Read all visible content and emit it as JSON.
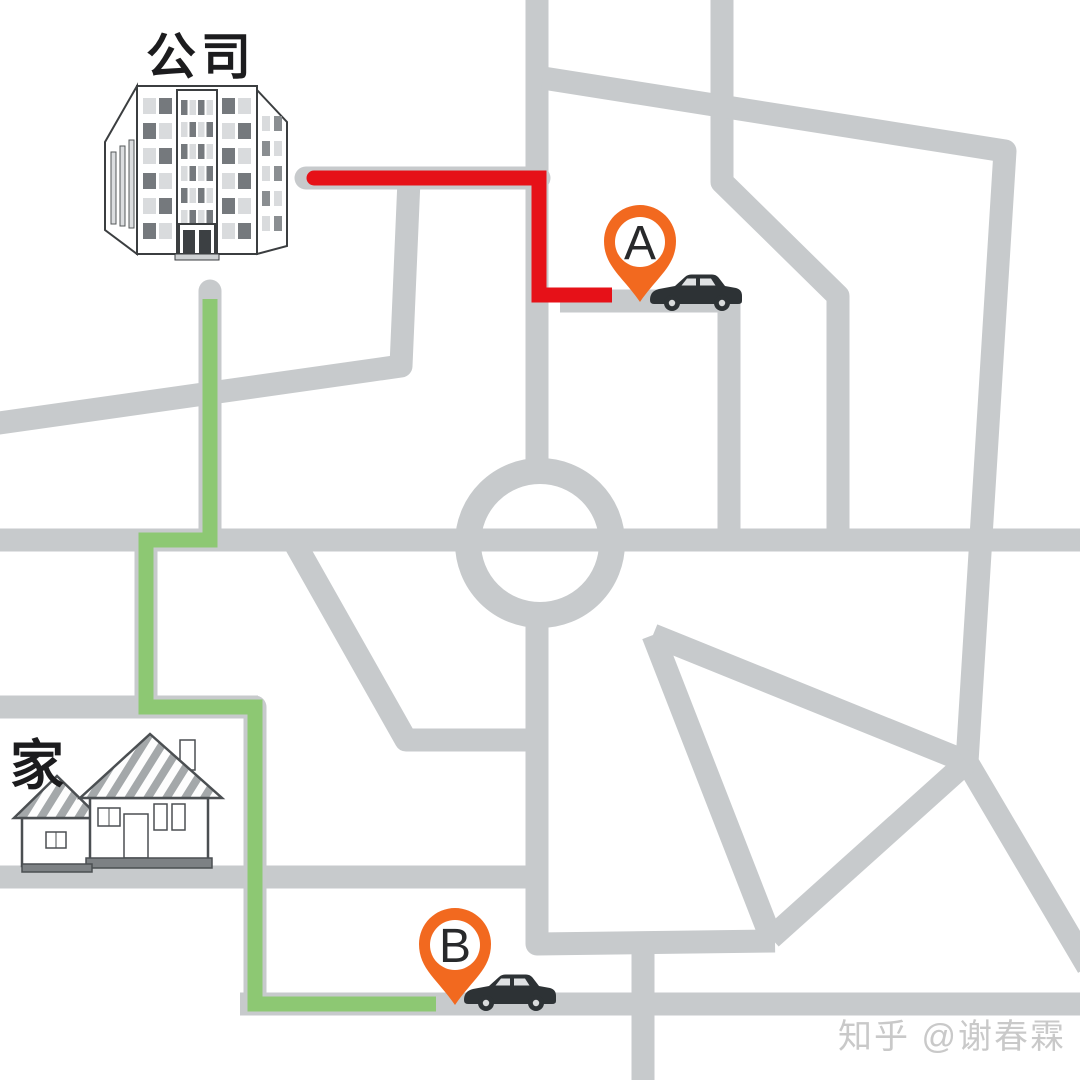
{
  "scene": {
    "company_label": "公司",
    "home_label": "家",
    "watermark": "知乎 @谢春霖"
  },
  "pins": [
    {
      "label": "A"
    },
    {
      "label": "B"
    }
  ],
  "routes": [
    {
      "name": "red-route",
      "color_key": "route_red"
    },
    {
      "name": "green-route",
      "color_key": "route_green"
    }
  ],
  "icons": {
    "pin": "map-pin",
    "car": "car-silhouette",
    "company": "office-building",
    "home": "house"
  },
  "colors": {
    "background": "#ffffff",
    "road": "#c7cacc",
    "route_red": "#e61118",
    "route_green": "#8dc873",
    "pin_orange": "#f2691f",
    "car_dark": "#2d3235",
    "label_text": "#1c1c1e",
    "watermark_gray": "#c9c9c9"
  }
}
